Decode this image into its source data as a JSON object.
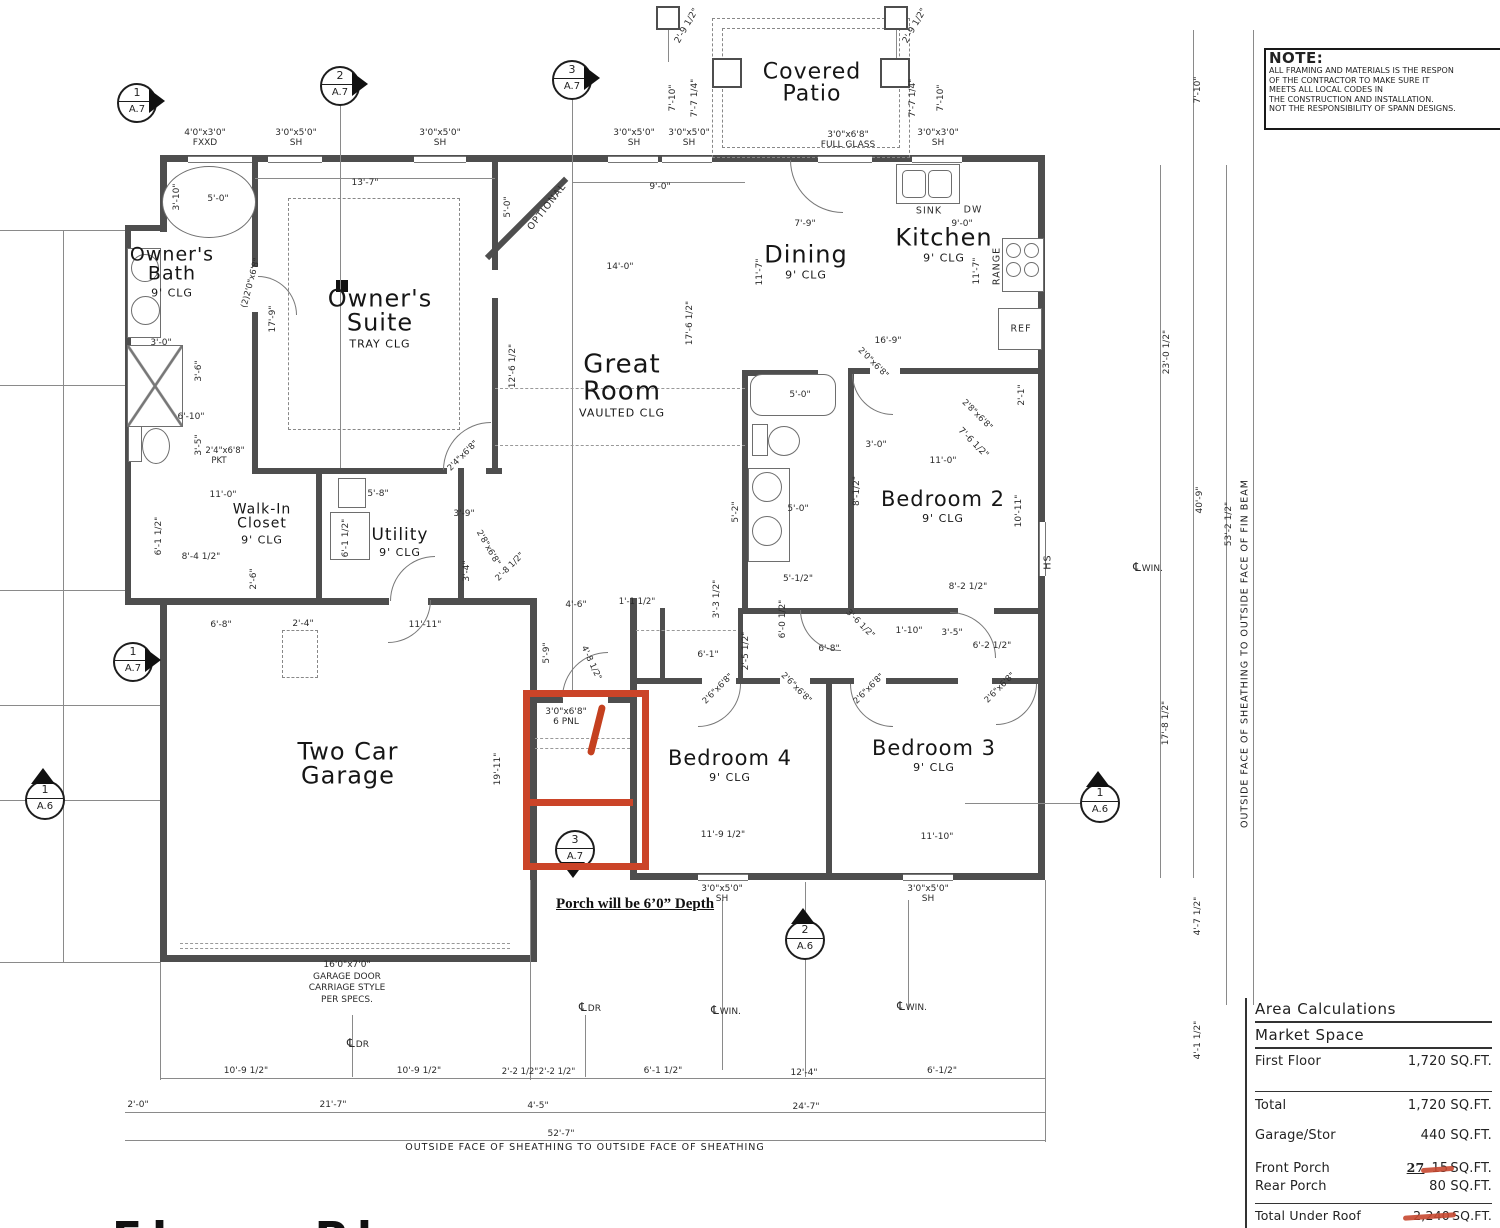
{
  "note": {
    "title": "NOTE:",
    "lines": [
      "ALL  FRAMING AND MATERIALS IS THE RESPON",
      "OF THE CONTRACTOR TO MAKE SURE IT",
      "MEETS ALL LOCAL CODES IN",
      "THE CONSTRUCTION AND INSTALLATION.",
      "NOT THE RESPONSIBILITY OF SPANN DESIGNS."
    ]
  },
  "area_table": {
    "title": "Area Calculations",
    "subtitle": "Market Space",
    "rows": [
      {
        "label": "First Floor",
        "value": "1,720 SQ.FT."
      },
      {
        "label": "Total",
        "value": "1,720 SQ.FT."
      },
      {
        "label": "Garage/Stor",
        "value": "440 SQ.FT."
      },
      {
        "label": "Front Porch",
        "correction": "27",
        "struck": "15",
        "unit": "SQ.FT."
      },
      {
        "label": "Rear Porch",
        "value": "80 SQ.FT."
      },
      {
        "label": "Total Under Roof",
        "struck": "2,240",
        "unit": "SQ.FT."
      }
    ],
    "corrected_total": "2,267"
  },
  "annotations": {
    "porch_note": "Porch will be 6’0” Depth"
  },
  "strings": {
    "outside_bottom": "OUTSIDE FACE OF SHEATHING  TO OUTSIDE FACE OF SHEATHING",
    "outside_right": "OUTSIDE FACE OF SHEATHING  TO OUTSIDE FACE OF FIN BEAM",
    "bottom_title": "Floor Plan"
  },
  "garage_door_label": [
    "16'0\"x7'0\"",
    "GARAGE DOOR",
    "CARRIAGE STYLE",
    "PER SPECS."
  ],
  "rooms": [
    {
      "n": "Owner's\nBath",
      "s": "9' CLG",
      "x": 172,
      "y": 272,
      "fs": 19
    },
    {
      "n": "Owner's\nSuite",
      "s": "TRAY CLG",
      "x": 380,
      "y": 318,
      "fs": 24
    },
    {
      "n": "Great\nRoom",
      "s": "VAULTED CLG",
      "x": 622,
      "y": 385,
      "fs": 26
    },
    {
      "n": "Dining",
      "s": "9' CLG",
      "x": 806,
      "y": 262,
      "fs": 24
    },
    {
      "n": "Kitchen",
      "s": "9' CLG",
      "x": 944,
      "y": 245,
      "fs": 24
    },
    {
      "n": "Bedroom 2",
      "s": "9' CLG",
      "x": 943,
      "y": 507,
      "fs": 21
    },
    {
      "n": "Walk-In\nCloset",
      "s": "9' CLG",
      "x": 262,
      "y": 524,
      "fs": 14
    },
    {
      "n": "Utility",
      "s": "9' CLG",
      "x": 400,
      "y": 543,
      "fs": 17
    },
    {
      "n": "Two Car\nGarage",
      "s": "",
      "x": 348,
      "y": 764,
      "fs": 24
    },
    {
      "n": "Bedroom 4",
      "s": "9' CLG",
      "x": 730,
      "y": 766,
      "fs": 21
    },
    {
      "n": "Bedroom 3",
      "s": "9' CLG",
      "x": 934,
      "y": 756,
      "fs": 21
    },
    {
      "n": "Covered\nPatio",
      "s": "",
      "x": 812,
      "y": 84,
      "fs": 22
    }
  ],
  "markers": [
    {
      "num": "1",
      "sheet": "A.7",
      "x": 137,
      "y": 103,
      "d": "right"
    },
    {
      "num": "2",
      "sheet": "A.7",
      "x": 340,
      "y": 86,
      "d": "right"
    },
    {
      "num": "3",
      "sheet": "A.7",
      "x": 572,
      "y": 80,
      "d": "right"
    },
    {
      "num": "1",
      "sheet": "A.7",
      "x": 133,
      "y": 662,
      "d": "right"
    },
    {
      "num": "1",
      "sheet": "A.6",
      "x": 45,
      "y": 800,
      "d": "up"
    },
    {
      "num": "1",
      "sheet": "A.6",
      "x": 1100,
      "y": 803,
      "d": "up"
    },
    {
      "num": "3",
      "sheet": "A.7",
      "x": 575,
      "y": 850,
      "d": "down"
    },
    {
      "num": "2",
      "sheet": "A.6",
      "x": 805,
      "y": 940,
      "d": "up"
    }
  ],
  "window_labels": [
    {
      "t": "4'0\"x3'0\"\nFXXD",
      "x": 205,
      "y": 139
    },
    {
      "t": "3'0\"x5'0\"\nSH",
      "x": 296,
      "y": 139
    },
    {
      "t": "3'0\"x5'0\"\nSH",
      "x": 440,
      "y": 139
    },
    {
      "t": "3'0\"x5'0\"\nSH",
      "x": 634,
      "y": 139
    },
    {
      "t": "3'0\"x5'0\"\nSH",
      "x": 689,
      "y": 139
    },
    {
      "t": "3'0\"x6'8\"\nFULL GLASS",
      "x": 848,
      "y": 141
    },
    {
      "t": "3'0\"x3'0\"\nSH",
      "x": 938,
      "y": 139
    },
    {
      "t": "3'0\"x5'0\"\nSH",
      "x": 722,
      "y": 895
    },
    {
      "t": "3'0\"x5'0\"\nSH",
      "x": 928,
      "y": 895
    },
    {
      "t": "3'0\"x6'8\"\n6 PNL",
      "x": 566,
      "y": 718
    }
  ],
  "fixture_labels": [
    {
      "t": "SINK",
      "x": 929,
      "y": 211
    },
    {
      "t": "DW",
      "x": 973,
      "y": 210
    },
    {
      "t": "RANGE",
      "x": 997,
      "y": 266,
      "r": -90
    },
    {
      "t": "REF",
      "x": 1021,
      "y": 329
    },
    {
      "t": "OPTIONAL",
      "x": 547,
      "y": 207,
      "r": -52
    },
    {
      "t": "HS",
      "x": 1048,
      "y": 562,
      "r": -90
    }
  ],
  "cl_labels": [
    {
      "t": "DR",
      "x": 590,
      "y": 1007
    },
    {
      "t": "DR",
      "x": 358,
      "y": 1043
    },
    {
      "t": "WIN.",
      "x": 726,
      "y": 1010
    },
    {
      "t": "WIN.",
      "x": 912,
      "y": 1006
    },
    {
      "t": "WIN.",
      "x": 1148,
      "y": 567
    }
  ],
  "dimensions": [
    {
      "t": "13'-7\"",
      "x": 365,
      "y": 183
    },
    {
      "t": "9'-0\"",
      "x": 660,
      "y": 187
    },
    {
      "t": "5'-0\"",
      "x": 218,
      "y": 199
    },
    {
      "t": "3'-10\"",
      "x": 177,
      "y": 197,
      "r": -90
    },
    {
      "t": "5'-0\"",
      "x": 508,
      "y": 207,
      "r": -90
    },
    {
      "t": "7'-10\"",
      "x": 673,
      "y": 98,
      "r": -90
    },
    {
      "t": "7'-7 1/4\"",
      "x": 695,
      "y": 98,
      "r": -90
    },
    {
      "t": "2'-9 1/2\"",
      "x": 687,
      "y": 26,
      "r": -60
    },
    {
      "t": "2'-9 1/2\"",
      "x": 915,
      "y": 26,
      "r": -60
    },
    {
      "t": "7'-7 1/4\"",
      "x": 913,
      "y": 98,
      "r": -90
    },
    {
      "t": "7'-10\"",
      "x": 941,
      "y": 98,
      "r": -90
    },
    {
      "t": "7'-10\"",
      "x": 1198,
      "y": 90,
      "r": -90
    },
    {
      "t": "14'-0\"",
      "x": 620,
      "y": 267
    },
    {
      "t": "7'-9\"",
      "x": 805,
      "y": 224
    },
    {
      "t": "9'-0\"",
      "x": 962,
      "y": 224
    },
    {
      "t": "11'-7\"",
      "x": 760,
      "y": 272,
      "r": -90
    },
    {
      "t": "11'-7\"",
      "x": 977,
      "y": 271,
      "r": -90
    },
    {
      "t": "16'-9\"",
      "x": 888,
      "y": 341
    },
    {
      "t": "17'-6 1/2\"",
      "x": 690,
      "y": 323,
      "r": -90
    },
    {
      "t": "12'-6 1/2\"",
      "x": 513,
      "y": 366,
      "r": -90
    },
    {
      "t": "17'-9\"",
      "x": 273,
      "y": 319,
      "r": -90
    },
    {
      "t": "3'-0\"",
      "x": 161,
      "y": 343
    },
    {
      "t": "3'-6\"",
      "x": 199,
      "y": 371,
      "r": -90
    },
    {
      "t": "6'-10\"",
      "x": 191,
      "y": 417
    },
    {
      "t": "3'-5\"",
      "x": 199,
      "y": 445,
      "r": -90
    },
    {
      "t": "(2)2'0\"x6'8\"",
      "x": 251,
      "y": 283,
      "r": -75,
      "fs": 8.5
    },
    {
      "t": "2'4\"x6'8\"",
      "x": 225,
      "y": 451,
      "fs": 8.5
    },
    {
      "t": "PKT",
      "x": 219,
      "y": 461,
      "fs": 8.5
    },
    {
      "t": "2'4\"x6'8\"",
      "x": 463,
      "y": 456,
      "r": -45,
      "fs": 8.5
    },
    {
      "t": "11'-0\"",
      "x": 223,
      "y": 495
    },
    {
      "t": "8'-4 1/2\"",
      "x": 201,
      "y": 557
    },
    {
      "t": "6'-1 1/2\"",
      "x": 159,
      "y": 536,
      "r": -90
    },
    {
      "t": "2'-6\"",
      "x": 254,
      "y": 579,
      "r": -90
    },
    {
      "t": "5'-8\"",
      "x": 378,
      "y": 494
    },
    {
      "t": "3'-9\"",
      "x": 464,
      "y": 514
    },
    {
      "t": "6'-1 1/2\"",
      "x": 346,
      "y": 538,
      "r": -90
    },
    {
      "t": "3'-4\"",
      "x": 467,
      "y": 571,
      "r": -90
    },
    {
      "t": "2'-8 1/2\"",
      "x": 510,
      "y": 567,
      "r": -45,
      "fs": 8.5
    },
    {
      "t": "2'8\"x6'8\"",
      "x": 488,
      "y": 548,
      "r": 60,
      "fs": 8.5
    },
    {
      "t": "5'-0\"",
      "x": 800,
      "y": 395
    },
    {
      "t": "3'-0\"",
      "x": 876,
      "y": 445
    },
    {
      "t": "11'-0\"",
      "x": 943,
      "y": 461
    },
    {
      "t": "8'-1/2\"",
      "x": 857,
      "y": 491,
      "r": -90
    },
    {
      "t": "10'-11\"",
      "x": 1019,
      "y": 511,
      "r": -90
    },
    {
      "t": "8'-2 1/2\"",
      "x": 968,
      "y": 587
    },
    {
      "t": "5'-1/2\"",
      "x": 798,
      "y": 579
    },
    {
      "t": "5'-0\"",
      "x": 798,
      "y": 509
    },
    {
      "t": "5'-2\"",
      "x": 736,
      "y": 512,
      "r": -90
    },
    {
      "t": "2'-1\"",
      "x": 1022,
      "y": 395,
      "r": -90
    },
    {
      "t": "2'0\"x6'8\"",
      "x": 873,
      "y": 363,
      "r": 45,
      "fs": 8.5
    },
    {
      "t": "2'8\"x6'8\"",
      "x": 977,
      "y": 415,
      "r": 45,
      "fs": 8.5
    },
    {
      "t": "7'-6 1/2\"",
      "x": 973,
      "y": 443,
      "r": 45
    },
    {
      "t": "4'-6\"",
      "x": 576,
      "y": 605
    },
    {
      "t": "1'-1 1/2\"",
      "x": 637,
      "y": 602,
      "fs": 8.5
    },
    {
      "t": "5'-9\"",
      "x": 547,
      "y": 653,
      "r": -90
    },
    {
      "t": "4'-8 1/2\"",
      "x": 591,
      "y": 663,
      "r": 65,
      "fs": 8.5
    },
    {
      "t": "3'-3 1/2\"",
      "x": 717,
      "y": 599,
      "r": -90
    },
    {
      "t": "6'-0 1/2\"",
      "x": 783,
      "y": 619,
      "r": -90
    },
    {
      "t": "2'-5 1/2\"",
      "x": 746,
      "y": 651,
      "r": -90
    },
    {
      "t": "6'-1\"",
      "x": 708,
      "y": 655
    },
    {
      "t": "6'-8\"",
      "x": 829,
      "y": 649
    },
    {
      "t": "1'-10\"",
      "x": 909,
      "y": 631
    },
    {
      "t": "3'-6 1/2\"",
      "x": 860,
      "y": 624,
      "r": 45,
      "fs": 8.5
    },
    {
      "t": "3'-5\"",
      "x": 952,
      "y": 633
    },
    {
      "t": "6'-2 1/2\"",
      "x": 992,
      "y": 646
    },
    {
      "t": "2'6\"x6'8\"",
      "x": 718,
      "y": 689,
      "r": -45,
      "fs": 8.5
    },
    {
      "t": "2'6\"x6'8\"",
      "x": 796,
      "y": 688,
      "r": 45,
      "fs": 8.5
    },
    {
      "t": "2'6\"x6'8\"",
      "x": 869,
      "y": 689,
      "r": -45,
      "fs": 8.5
    },
    {
      "t": "2'6\"x6'8\"",
      "x": 1000,
      "y": 688,
      "r": -45,
      "fs": 8.5
    },
    {
      "t": "6'-8\"",
      "x": 221,
      "y": 625
    },
    {
      "t": "2'-4\"",
      "x": 303,
      "y": 624
    },
    {
      "t": "11'-11\"",
      "x": 425,
      "y": 625
    },
    {
      "t": "19'-11\"",
      "x": 498,
      "y": 769,
      "r": -90
    },
    {
      "t": "11'-9 1/2\"",
      "x": 723,
      "y": 835
    },
    {
      "t": "11'-10\"",
      "x": 937,
      "y": 837
    },
    {
      "t": "23'-0 1/2\"",
      "x": 1167,
      "y": 352,
      "r": -90
    },
    {
      "t": "40'-9\"",
      "x": 1200,
      "y": 500,
      "r": -90
    },
    {
      "t": "53'-2 1/2\"",
      "x": 1229,
      "y": 524,
      "r": -90
    },
    {
      "t": "17'-8 1/2\"",
      "x": 1166,
      "y": 723,
      "r": -90
    },
    {
      "t": "4'-7 1/2\"",
      "x": 1198,
      "y": 916,
      "r": -90
    },
    {
      "t": "4'-1 1/2\"",
      "x": 1198,
      "y": 1040,
      "r": -90
    },
    {
      "t": "10'-9 1/2\"",
      "x": 246,
      "y": 1071
    },
    {
      "t": "10'-9 1/2\"",
      "x": 419,
      "y": 1071
    },
    {
      "t": "2'-2 1/2\"",
      "x": 520,
      "y": 1072,
      "fs": 8.5
    },
    {
      "t": "2'-2 1/2\"",
      "x": 557,
      "y": 1072,
      "fs": 8.5
    },
    {
      "t": "6'-1 1/2\"",
      "x": 663,
      "y": 1071
    },
    {
      "t": "12'-4\"",
      "x": 804,
      "y": 1073
    },
    {
      "t": "6'-1/2\"",
      "x": 942,
      "y": 1071
    },
    {
      "t": "2'-0\"",
      "x": 138,
      "y": 1105
    },
    {
      "t": "21'-7\"",
      "x": 333,
      "y": 1105
    },
    {
      "t": "4'-5\"",
      "x": 538,
      "y": 1106
    },
    {
      "t": "24'-7\"",
      "x": 806,
      "y": 1107
    },
    {
      "t": "52'-7\"",
      "x": 561,
      "y": 1134
    }
  ]
}
